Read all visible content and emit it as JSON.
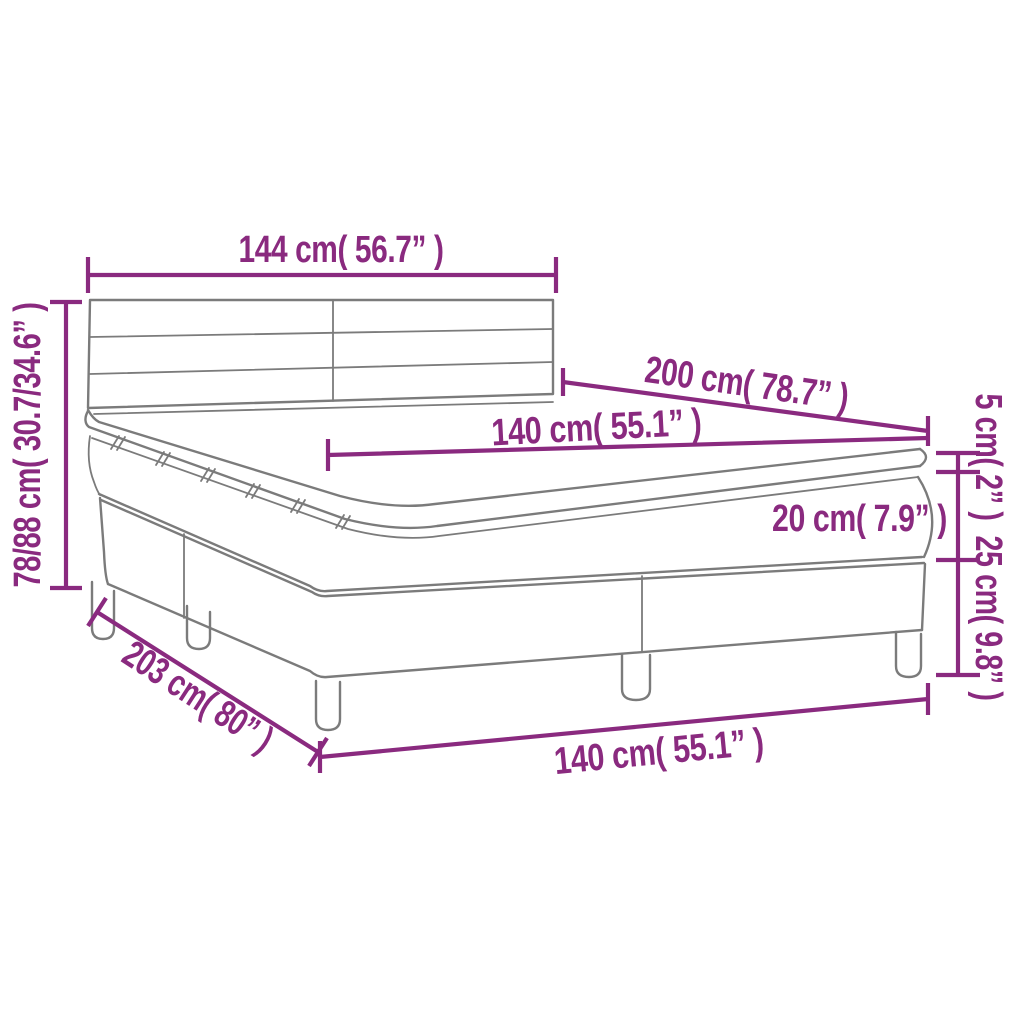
{
  "page": {
    "background": "#ffffff"
  },
  "diagram": {
    "subject": "Box spring bed with mattress and topper — dimension drawing",
    "colors": {
      "dimension": "#8a2a7f",
      "outline": "#7b7b7b",
      "background": "#ffffff"
    },
    "labels": {
      "headboard_width": "144 cm( 56.7” )",
      "bed_height": "78/88 cm( 30.7/34.6” )",
      "mattress_length": "200 cm( 78.7” )",
      "mattress_width": "140 cm( 55.1” )",
      "topper_height": "5 cm( 2” )",
      "mattress_height": "20 cm( 7.9” )",
      "base_height": "25 cm( 9.8” )",
      "frame_length": "203 cm( 80” )",
      "frame_width": "140 cm( 55.1” )"
    }
  }
}
